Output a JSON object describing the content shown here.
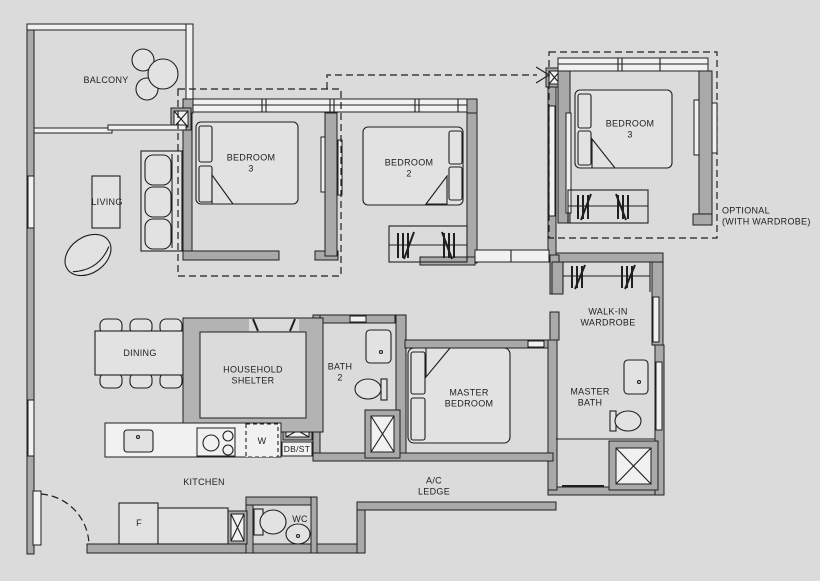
{
  "title": "Residential unit floor plan",
  "colors": {
    "background": "#dbdbdb",
    "wall": "#a9a9a9",
    "shelter_wall": "#b3b3b3",
    "window_white": "#f1f1f1",
    "line": "#1f1f1f",
    "text": "#1e1e1e"
  },
  "rooms": {
    "balcony": {
      "label": "BALCONY"
    },
    "living": {
      "label": "LIVING"
    },
    "dining": {
      "label": "DINING"
    },
    "bedroom3": {
      "line1": "BEDROOM",
      "line2": "3"
    },
    "bedroom2": {
      "line1": "BEDROOM",
      "line2": "2"
    },
    "bedroom3_optional": {
      "line1": "BEDROOM",
      "line2": "3"
    },
    "optional_note": {
      "line1": "OPTIONAL",
      "line2": "(WITH WARDROBE)"
    },
    "walk_in_wardrobe": {
      "line1": "WALK-IN",
      "line2": "WARDROBE"
    },
    "household_shelter": {
      "line1": "HOUSEHOLD",
      "line2": "SHELTER"
    },
    "bath2": {
      "line1": "BATH",
      "line2": "2"
    },
    "master_bedroom": {
      "line1": "MASTER",
      "line2": "BEDROOM"
    },
    "master_bath": {
      "line1": "MASTER",
      "line2": "BATH"
    },
    "kitchen": {
      "label": "KITCHEN"
    },
    "ac_ledge": {
      "line1": "A/C",
      "line2": "LEDGE"
    },
    "wc": {
      "label": "WC"
    }
  },
  "appliances": {
    "washer": "W",
    "db_st": "DB/ST",
    "fridge": "F"
  }
}
